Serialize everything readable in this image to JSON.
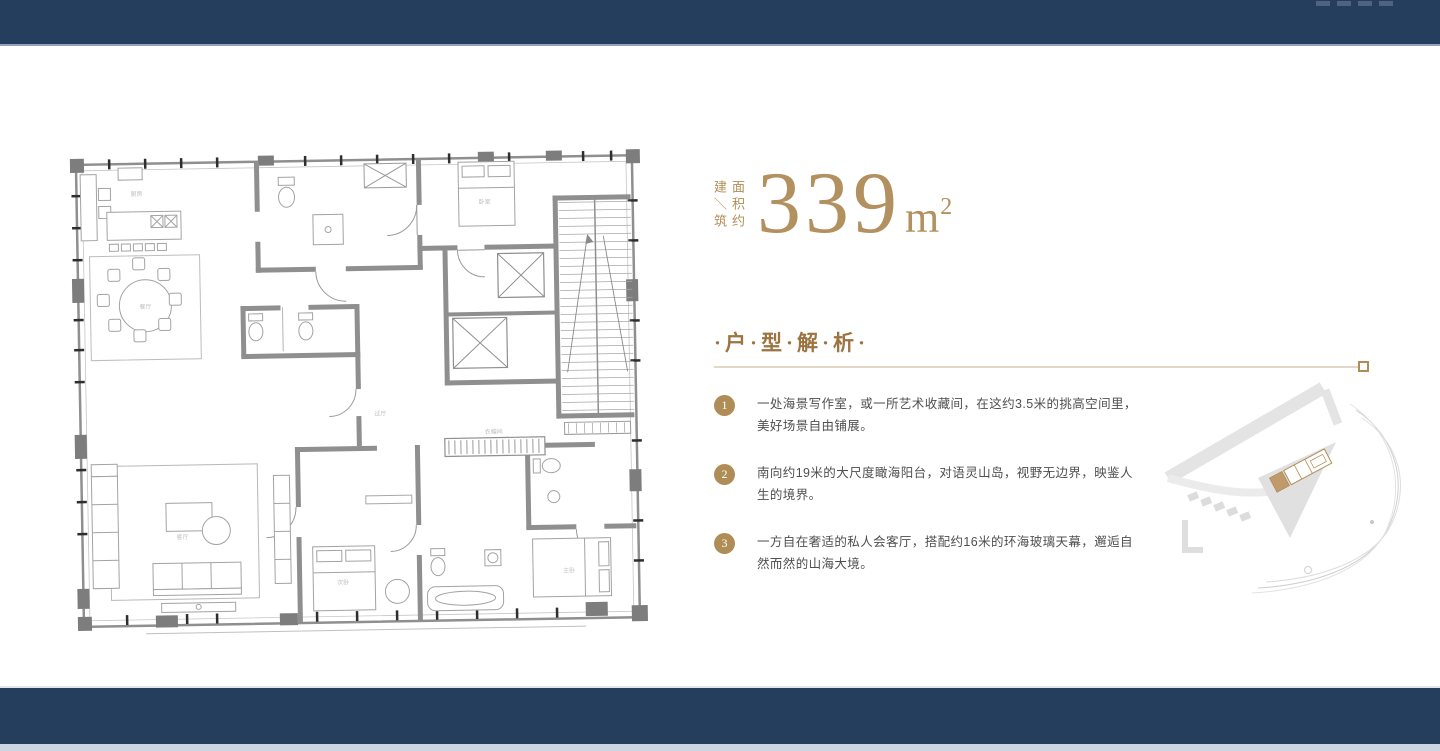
{
  "area": {
    "label_left": "建＼筑",
    "label_right": "面积约",
    "value": "339",
    "unit": "m",
    "unit_sup": "2"
  },
  "section": {
    "title": "·户·型·解·析·"
  },
  "analysis": {
    "items": [
      {
        "num": "1",
        "text": "一处海景写作室，或一所艺术收藏间，在这约3.5米的挑高空间里，美好场景自由铺展。"
      },
      {
        "num": "2",
        "text": "南向约19米的大尺度瞰海阳台，对语灵山岛，视野无边界，映鉴人生的境界。"
      },
      {
        "num": "3",
        "text": "一方自在奢适的私人会客厅，搭配约16米的环海玻璃天幕，邂逅自然而然的山海大境。"
      }
    ]
  },
  "floorplan": {
    "room_labels": [
      "厨房",
      "餐厅",
      "客厅",
      "主卧",
      "次卧",
      "卧室",
      "过厅",
      "衣帽间"
    ]
  },
  "colors": {
    "navy": "#263e5e",
    "gold": "#b08d57",
    "heading_gold": "#9d7342",
    "body_text": "#4f4f4f",
    "divider": "#e3d8c8",
    "bottom_strip": "#ccd5e2"
  }
}
